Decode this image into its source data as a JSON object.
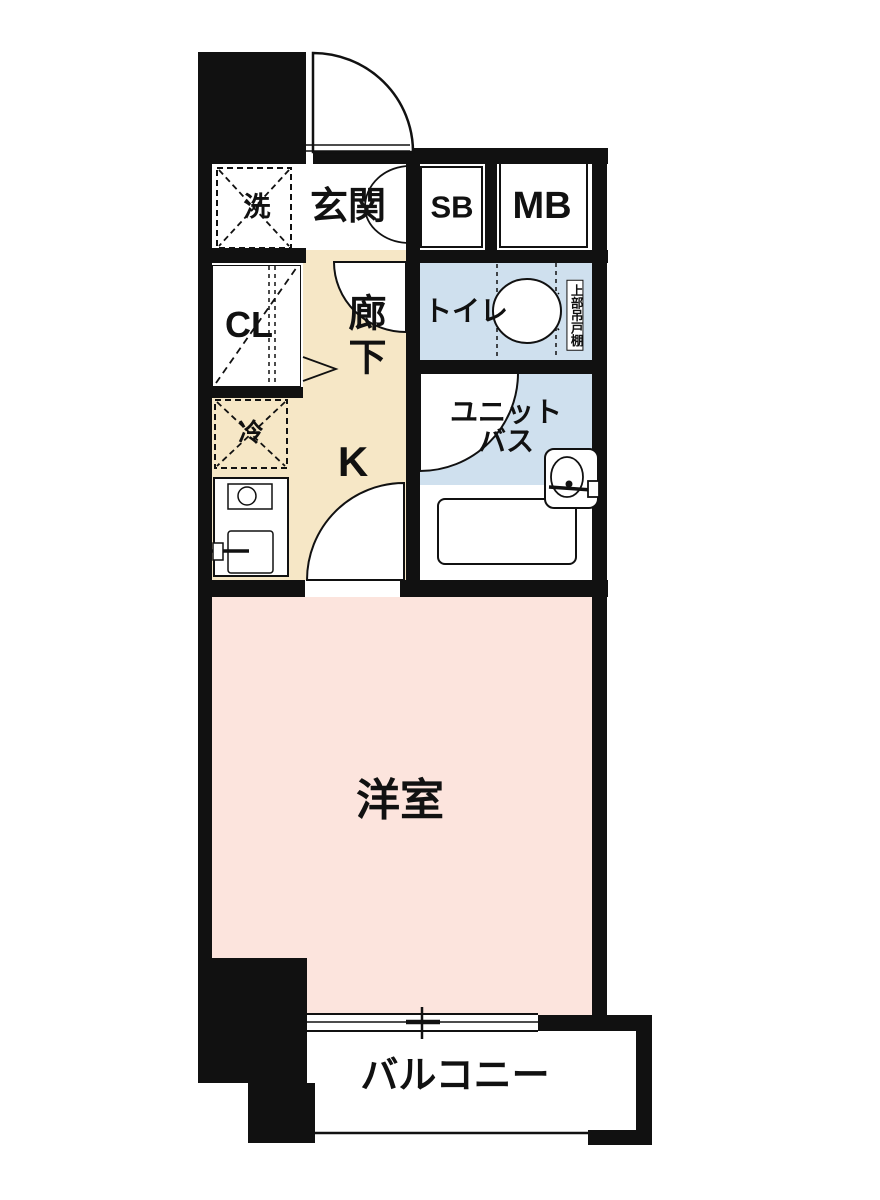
{
  "floorplan": {
    "type": "1K apartment floor plan",
    "colors": {
      "wall": "#111111",
      "line": "#111111",
      "floor_kitchen": "#f6e7c6",
      "floor_room": "#fce4dd",
      "floor_wet": "#cfe0ee"
    },
    "rooms": {
      "entrance": {
        "label": "玄関"
      },
      "washer": {
        "label": "洗"
      },
      "shoebox": {
        "label": "SB"
      },
      "meterbox": {
        "label": "MB"
      },
      "closet": {
        "label": "CL"
      },
      "corridor": {
        "label": "廊下"
      },
      "toilet": {
        "label": "トイレ"
      },
      "upper_cabinet": {
        "label": "上部吊戸棚"
      },
      "fridge": {
        "label": "冷"
      },
      "kitchen": {
        "label": "K"
      },
      "unit_bath": {
        "line1": "ユニット",
        "line2": "バス"
      },
      "western_room": {
        "label": "洋室"
      },
      "balcony": {
        "label": "バルコニー"
      }
    }
  }
}
